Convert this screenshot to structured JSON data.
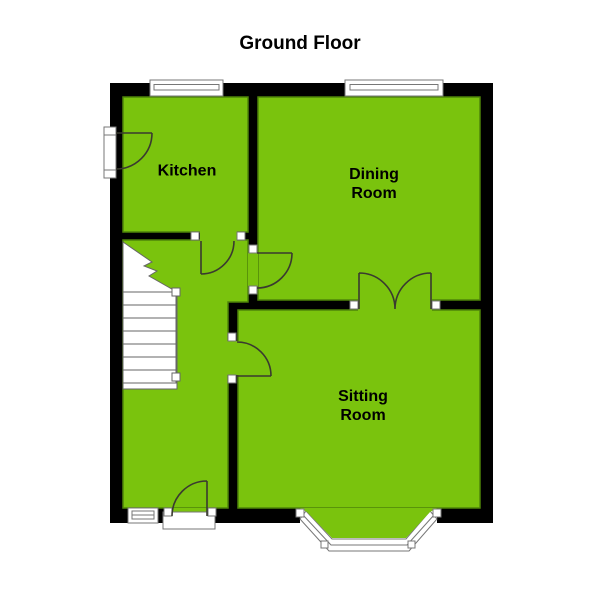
{
  "title": "Ground Floor",
  "rooms": {
    "kitchen": {
      "label": "Kitchen"
    },
    "dining": {
      "label": "Dining\nRoom"
    },
    "sitting": {
      "label": "Sitting\nRoom"
    }
  },
  "features": {
    "staircase": "stairs-up",
    "bay_window": "bay-window",
    "windows": 3,
    "doors": 6
  },
  "colors": {
    "background": "#FFFFFF",
    "wall": "#000000",
    "floor": "#7AC30D",
    "floor_outline": "#4E8409",
    "line": "#3A3A30",
    "frame": "#777777",
    "fixture": "#FFFFFF",
    "text": "#000000"
  }
}
